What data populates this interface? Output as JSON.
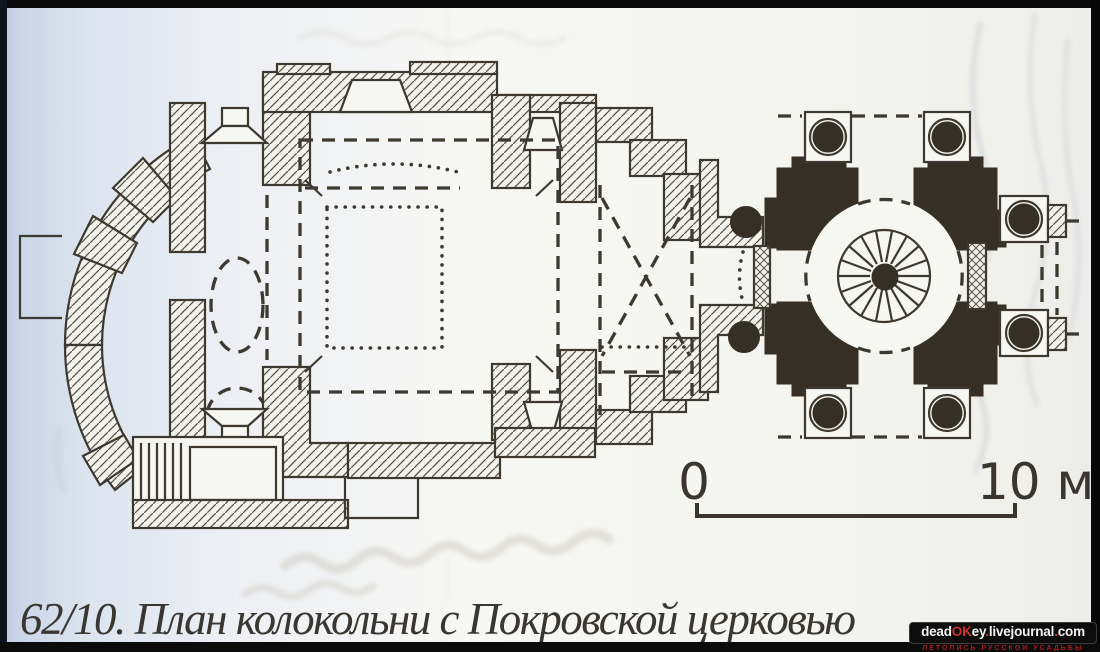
{
  "page": {
    "caption": "62/10. План колокольни с Покровской церковью"
  },
  "scale_bar": {
    "start_label": "0",
    "end_label": "10 м"
  },
  "watermark": {
    "part_dead": "dead",
    "part_ok": "OK",
    "part_ey": "ey",
    "dot1": ".",
    "part_livejournal": "livejournal",
    "dot2": ".",
    "part_com": "com",
    "tagline": "летопись русской усадьбы"
  },
  "colors": {
    "ink": "#3e3930",
    "pier_fill": "#362f25",
    "paper_white": "#f7f7f4",
    "paper_blue_edge": "#c9d4e6",
    "watermark_red": "#d03028",
    "badge_background": "#0c0c0c"
  }
}
